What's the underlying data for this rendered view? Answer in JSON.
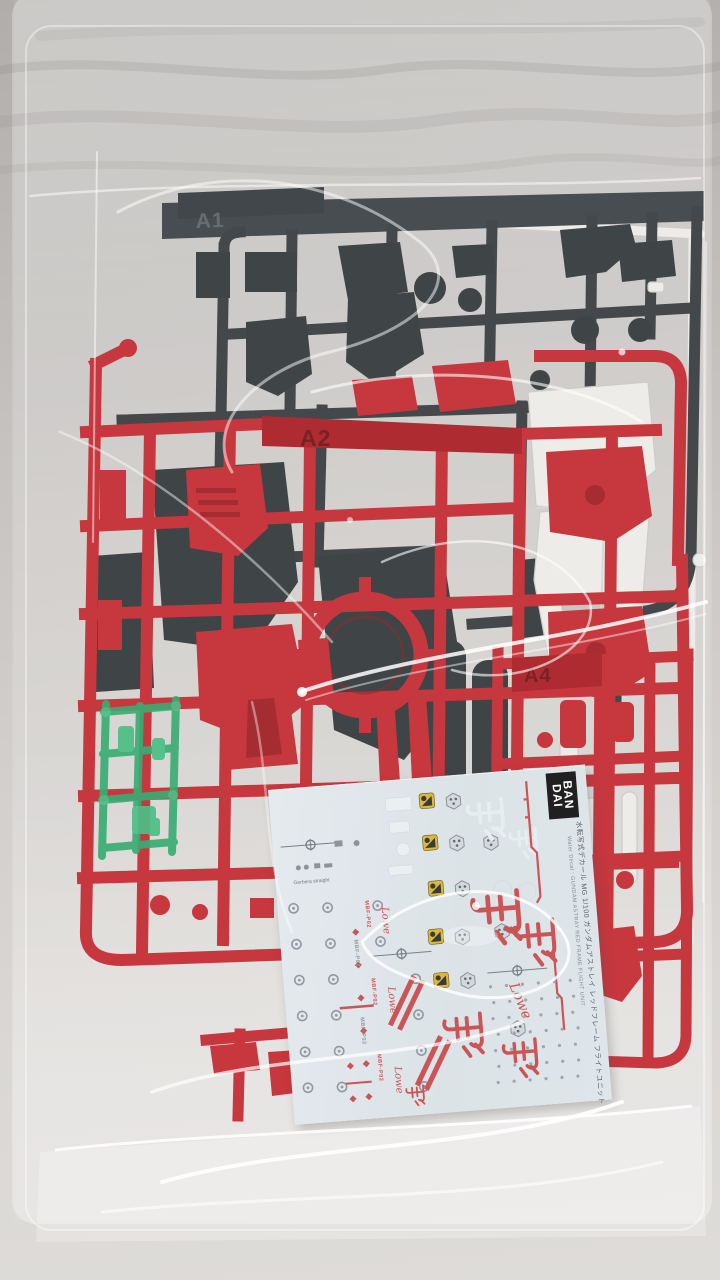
{
  "meta": {
    "description": "Sealed clear bag containing Bandai Gundam model kit runners and a water decal sheet on a light gray surface"
  },
  "sprues": {
    "dark": {
      "label": "A1",
      "color": "#363b3e",
      "part_color": "#31373a"
    },
    "red_main": {
      "label": "A2",
      "color": "#c32830",
      "accent_color": "#8c181d"
    },
    "red_small": {
      "label": "A4",
      "color": "#c32830"
    },
    "white": {
      "color": "#ecebe8"
    },
    "clear_green": {
      "color": "#2aa768",
      "part_color": "#3fbb7d"
    }
  },
  "decal_sheet": {
    "paper_color": "#dde4e9",
    "brand": {
      "line1": "BAN",
      "line2": "DAI"
    },
    "title_jp": "水転写式デカール MG 1/100 ガンダムアストレイ レッドフレーム フライトユニット",
    "title_en": "Water Decal : GUNDAM ASTRAY RED FRAME FLIGHT UNIT",
    "note": "Gerbera straight",
    "marking_code": "MBF-P02",
    "signature": "Lowe",
    "kanji": "飛",
    "caution_yellow": "#d9b32e",
    "marking_red": "#c8474b",
    "marking_gray": "#8a9298"
  },
  "background": {
    "surface_top": "#b0adaa",
    "surface_bottom": "#dedcd9"
  }
}
